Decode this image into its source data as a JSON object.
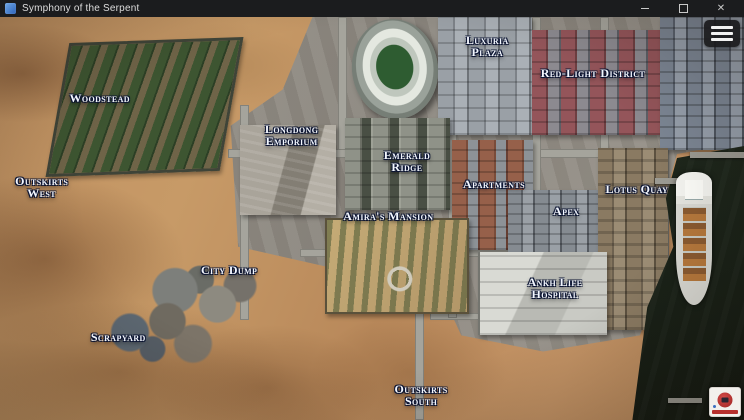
{
  "window": {
    "title": "Symphony of the Serpent",
    "controls": {
      "close": "✕"
    }
  },
  "map": {
    "name": "city-overview-map",
    "locations": [
      {
        "id": "woodstead",
        "lines": [
          "Woodstead"
        ],
        "x": 13.4,
        "y": 20.1
      },
      {
        "id": "outskirts-west",
        "lines": [
          "Outskirts",
          "West"
        ],
        "x": 5.6,
        "y": 42.2
      },
      {
        "id": "longdong-emporium",
        "lines": [
          "Longdong",
          "Emporium"
        ],
        "x": 39.2,
        "y": 29.3
      },
      {
        "id": "emerald-ridge",
        "lines": [
          "Emerald",
          "Ridge"
        ],
        "x": 54.7,
        "y": 35.7
      },
      {
        "id": "luxuria-plaza",
        "lines": [
          "Luxuria",
          "Plaza"
        ],
        "x": 65.5,
        "y": 7.2
      },
      {
        "id": "red-light-district",
        "lines": [
          "Red-Light District"
        ],
        "x": 79.7,
        "y": 13.9
      },
      {
        "id": "apartments",
        "lines": [
          "Apartments"
        ],
        "x": 66.4,
        "y": 41.4
      },
      {
        "id": "apex",
        "lines": [
          "Apex"
        ],
        "x": 76.1,
        "y": 48.1
      },
      {
        "id": "lotus-quay",
        "lines": [
          "Lotus Quay"
        ],
        "x": 85.6,
        "y": 42.7
      },
      {
        "id": "amiras-mansion",
        "lines": [
          "Amira's Mansion"
        ],
        "x": 52.2,
        "y": 49.4
      },
      {
        "id": "city-dump",
        "lines": [
          "City Dump"
        ],
        "x": 30.8,
        "y": 62.8
      },
      {
        "id": "ankh-life-hospital",
        "lines": [
          "Ankh Life",
          "Hospital"
        ],
        "x": 74.6,
        "y": 67.2
      },
      {
        "id": "scrapyard",
        "lines": [
          "Scrapyard"
        ],
        "x": 15.9,
        "y": 79.4
      },
      {
        "id": "outskirts-south",
        "lines": [
          "Outskirts",
          "South"
        ],
        "x": 56.6,
        "y": 93.8
      }
    ]
  },
  "hud": {
    "menu_icon": "hamburger-menu-icon",
    "logo_icon": "studio-logo-badge"
  },
  "colors": {
    "sand": "#c09161",
    "water": "#1e271c",
    "road": "#a5a49c",
    "label_text": "#f3f7ff",
    "label_outline": "#0c1533",
    "titlebar": "#1b1c1e"
  }
}
